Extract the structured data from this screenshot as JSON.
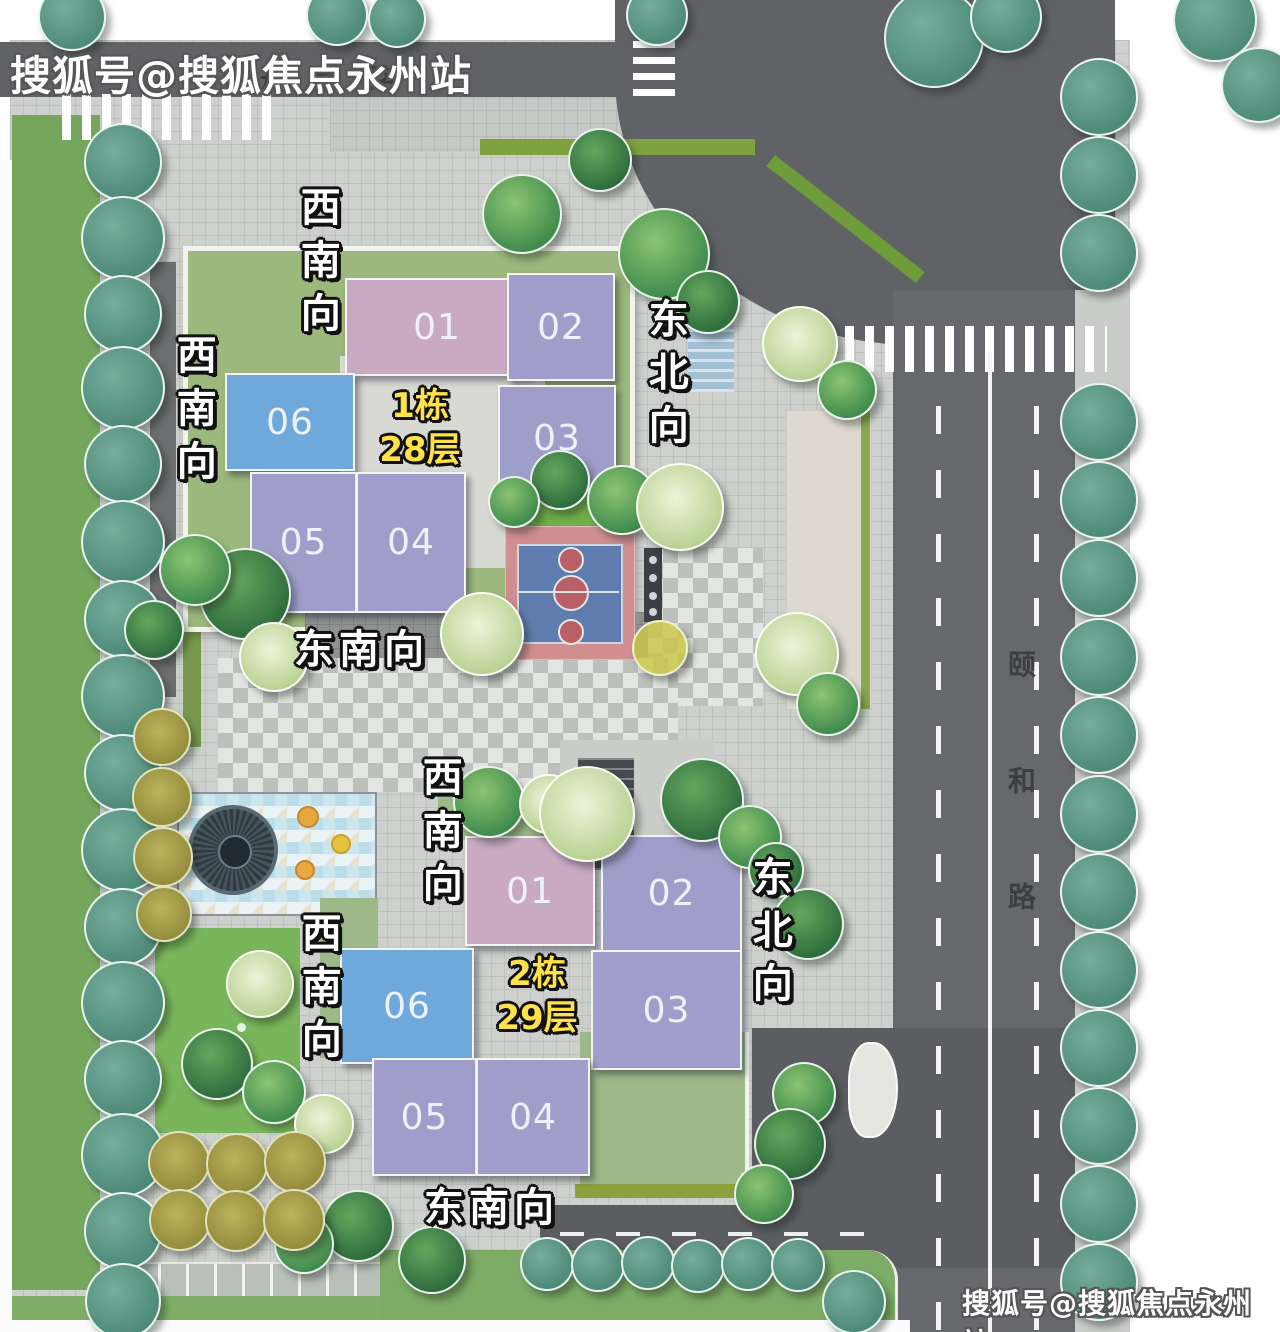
{
  "watermarks": {
    "top_left": "搜狐号@搜狐焦点永州站",
    "bottom_right": "搜狐号@搜狐焦点永州站"
  },
  "roads": {
    "north_label": "规划路",
    "east_label": "颐和路"
  },
  "buildings": [
    {
      "name": "1栋",
      "floors": "28层",
      "units": [
        {
          "label": "01"
        },
        {
          "label": "02"
        },
        {
          "label": "03"
        },
        {
          "label": "04"
        },
        {
          "label": "05"
        },
        {
          "label": "06"
        }
      ]
    },
    {
      "name": "2栋",
      "floors": "29层",
      "units": [
        {
          "label": "01"
        },
        {
          "label": "02"
        },
        {
          "label": "03"
        },
        {
          "label": "04"
        },
        {
          "label": "05"
        },
        {
          "label": "06"
        }
      ]
    }
  ],
  "orientation_labels": [
    {
      "text": "西南向",
      "building": "1栋",
      "side": "northwest"
    },
    {
      "text": "西南向",
      "building": "1栋",
      "side": "west"
    },
    {
      "text": "东北向",
      "building": "1栋",
      "side": "east"
    },
    {
      "text": "东南向",
      "building": "1栋",
      "side": "south"
    },
    {
      "text": "西南向",
      "building": "2栋",
      "side": "northwest"
    },
    {
      "text": "西南向",
      "building": "2栋",
      "side": "west"
    },
    {
      "text": "东北向",
      "building": "2栋",
      "side": "east"
    },
    {
      "text": "东南向",
      "building": "2栋",
      "side": "south"
    }
  ],
  "colors": {
    "unit_pink": "#c9aac2",
    "unit_purple": "#9f9ecb",
    "unit_blue": "#6fa9dc",
    "tag_yellow": "#ffe14a",
    "road_gray": "#616366",
    "tree_teal": "#56917f",
    "lawn_green": "#9cb87c"
  },
  "landscape": {
    "trees": [
      [
        70,
        15,
        32,
        "teal"
      ],
      [
        335,
        13,
        29,
        "teal"
      ],
      [
        395,
        17,
        27,
        "teal"
      ],
      [
        655,
        13,
        29,
        "teal"
      ],
      [
        932,
        36,
        48,
        "teal"
      ],
      [
        1004,
        15,
        34,
        "teal"
      ],
      [
        1213,
        18,
        40,
        "teal"
      ],
      [
        1257,
        83,
        36,
        "teal"
      ],
      [
        121,
        160,
        37,
        "teal"
      ],
      [
        121,
        236,
        40,
        "teal"
      ],
      [
        121,
        312,
        37,
        "teal"
      ],
      [
        121,
        386,
        40,
        "teal"
      ],
      [
        121,
        462,
        37,
        "teal"
      ],
      [
        121,
        540,
        40,
        "teal"
      ],
      [
        121,
        617,
        37,
        "teal"
      ],
      [
        121,
        694,
        40,
        "teal"
      ],
      [
        121,
        771,
        37,
        "teal"
      ],
      [
        121,
        848,
        40,
        "teal"
      ],
      [
        121,
        925,
        37,
        "teal"
      ],
      [
        121,
        1001,
        40,
        "teal"
      ],
      [
        121,
        1077,
        37,
        "teal"
      ],
      [
        121,
        1153,
        40,
        "teal"
      ],
      [
        121,
        1229,
        37,
        "teal"
      ],
      [
        121,
        1299,
        36,
        "teal"
      ],
      [
        1097,
        95,
        37,
        "teal"
      ],
      [
        1097,
        173,
        37,
        "teal"
      ],
      [
        1097,
        251,
        37,
        "teal"
      ],
      [
        1097,
        420,
        37,
        "teal"
      ],
      [
        1097,
        498,
        37,
        "teal"
      ],
      [
        1097,
        576,
        37,
        "teal"
      ],
      [
        1097,
        655,
        37,
        "teal"
      ],
      [
        1097,
        733,
        37,
        "teal"
      ],
      [
        1097,
        812,
        37,
        "teal"
      ],
      [
        1097,
        890,
        37,
        "teal"
      ],
      [
        1097,
        968,
        37,
        "teal"
      ],
      [
        1097,
        1046,
        37,
        "teal"
      ],
      [
        1097,
        1124,
        37,
        "teal"
      ],
      [
        1097,
        1202,
        37,
        "teal"
      ],
      [
        1097,
        1280,
        37,
        "teal"
      ],
      [
        545,
        1262,
        25,
        "teal"
      ],
      [
        596,
        1263,
        25,
        "teal"
      ],
      [
        646,
        1261,
        25,
        "teal"
      ],
      [
        696,
        1264,
        25,
        "teal"
      ],
      [
        746,
        1262,
        25,
        "teal"
      ],
      [
        796,
        1263,
        25,
        "teal"
      ],
      [
        852,
        1300,
        30,
        "teal"
      ],
      [
        520,
        212,
        38,
        "g"
      ],
      [
        598,
        158,
        30,
        "gd"
      ],
      [
        662,
        252,
        44,
        "g"
      ],
      [
        706,
        300,
        30,
        "gd"
      ],
      [
        798,
        342,
        36,
        "p"
      ],
      [
        845,
        388,
        28,
        "g"
      ],
      [
        558,
        478,
        28,
        "gd"
      ],
      [
        620,
        498,
        33,
        "g"
      ],
      [
        678,
        505,
        42,
        "p"
      ],
      [
        512,
        500,
        24,
        "g"
      ],
      [
        480,
        632,
        40,
        "p"
      ],
      [
        658,
        646,
        26,
        "y"
      ],
      [
        795,
        652,
        40,
        "p"
      ],
      [
        826,
        702,
        30,
        "g"
      ],
      [
        243,
        592,
        44,
        "gd"
      ],
      [
        193,
        568,
        34,
        "g"
      ],
      [
        272,
        655,
        33,
        "p"
      ],
      [
        152,
        628,
        28,
        "gd"
      ],
      [
        487,
        800,
        34,
        "g"
      ],
      [
        547,
        802,
        28,
        "p"
      ],
      [
        585,
        812,
        46,
        "p"
      ],
      [
        700,
        798,
        40,
        "gd"
      ],
      [
        748,
        835,
        30,
        "g"
      ],
      [
        774,
        868,
        26,
        "gd"
      ],
      [
        806,
        922,
        34,
        "gd"
      ],
      [
        802,
        1092,
        30,
        "g"
      ],
      [
        788,
        1142,
        34,
        "gd"
      ],
      [
        762,
        1192,
        28,
        "g"
      ],
      [
        258,
        982,
        32,
        "p"
      ],
      [
        215,
        1062,
        34,
        "gd"
      ],
      [
        272,
        1090,
        30,
        "g"
      ],
      [
        322,
        1122,
        28,
        "p"
      ],
      [
        356,
        1224,
        34,
        "gd"
      ],
      [
        302,
        1242,
        28,
        "g"
      ],
      [
        430,
        1258,
        32,
        "gd"
      ],
      [
        160,
        735,
        27,
        "o"
      ],
      [
        160,
        795,
        28,
        "o"
      ],
      [
        161,
        855,
        28,
        "o"
      ],
      [
        162,
        912,
        26,
        "o"
      ],
      [
        177,
        1160,
        29,
        "o"
      ],
      [
        235,
        1162,
        29,
        "o"
      ],
      [
        293,
        1160,
        29,
        "o"
      ],
      [
        178,
        1218,
        29,
        "o"
      ],
      [
        234,
        1219,
        29,
        "o"
      ],
      [
        292,
        1218,
        29,
        "o"
      ]
    ]
  }
}
